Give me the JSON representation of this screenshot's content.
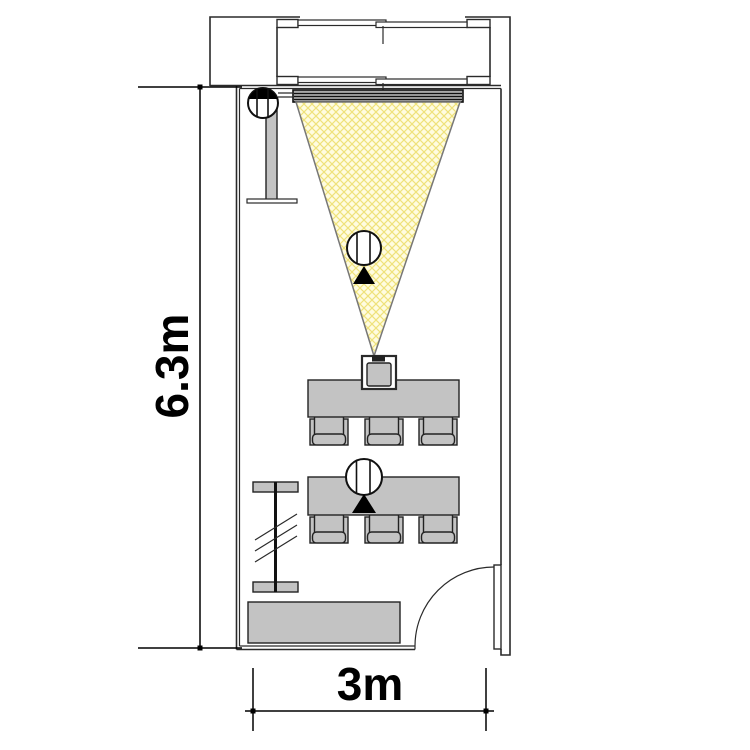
{
  "plan": {
    "type": "floor-plan",
    "title": "meeting-room-plan",
    "dimension_vertical_label": "6.3m",
    "dimension_horizontal_label": "3m",
    "colors": {
      "wall": "#2a2a2a",
      "furniture_fill": "#c3c3c3",
      "furniture_stroke": "#222222",
      "cone_fill": "#fffce0",
      "cone_hatch": "#efe27a",
      "cone_stroke": "#777777",
      "screen_fill": "#a8a8a8",
      "dimension": "#000000"
    },
    "symbols": [
      {
        "name": "camera-symbol-top-left",
        "marker": "filled-semicircle-up"
      },
      {
        "name": "camera-symbol-in-cone",
        "marker": "filled-triangle-up"
      },
      {
        "name": "camera-symbol-at-table",
        "marker": "filled-triangle-up"
      }
    ],
    "furniture": [
      {
        "name": "window-bay",
        "windows": 2
      },
      {
        "name": "projection-screen"
      },
      {
        "name": "projection-cone"
      },
      {
        "name": "projector"
      },
      {
        "name": "flipchart-stand"
      },
      {
        "name": "meeting-table",
        "count": 2
      },
      {
        "name": "chair",
        "count": 6
      },
      {
        "name": "radiator"
      },
      {
        "name": "sideboard"
      },
      {
        "name": "door",
        "swing": "quarter-arc"
      }
    ]
  }
}
